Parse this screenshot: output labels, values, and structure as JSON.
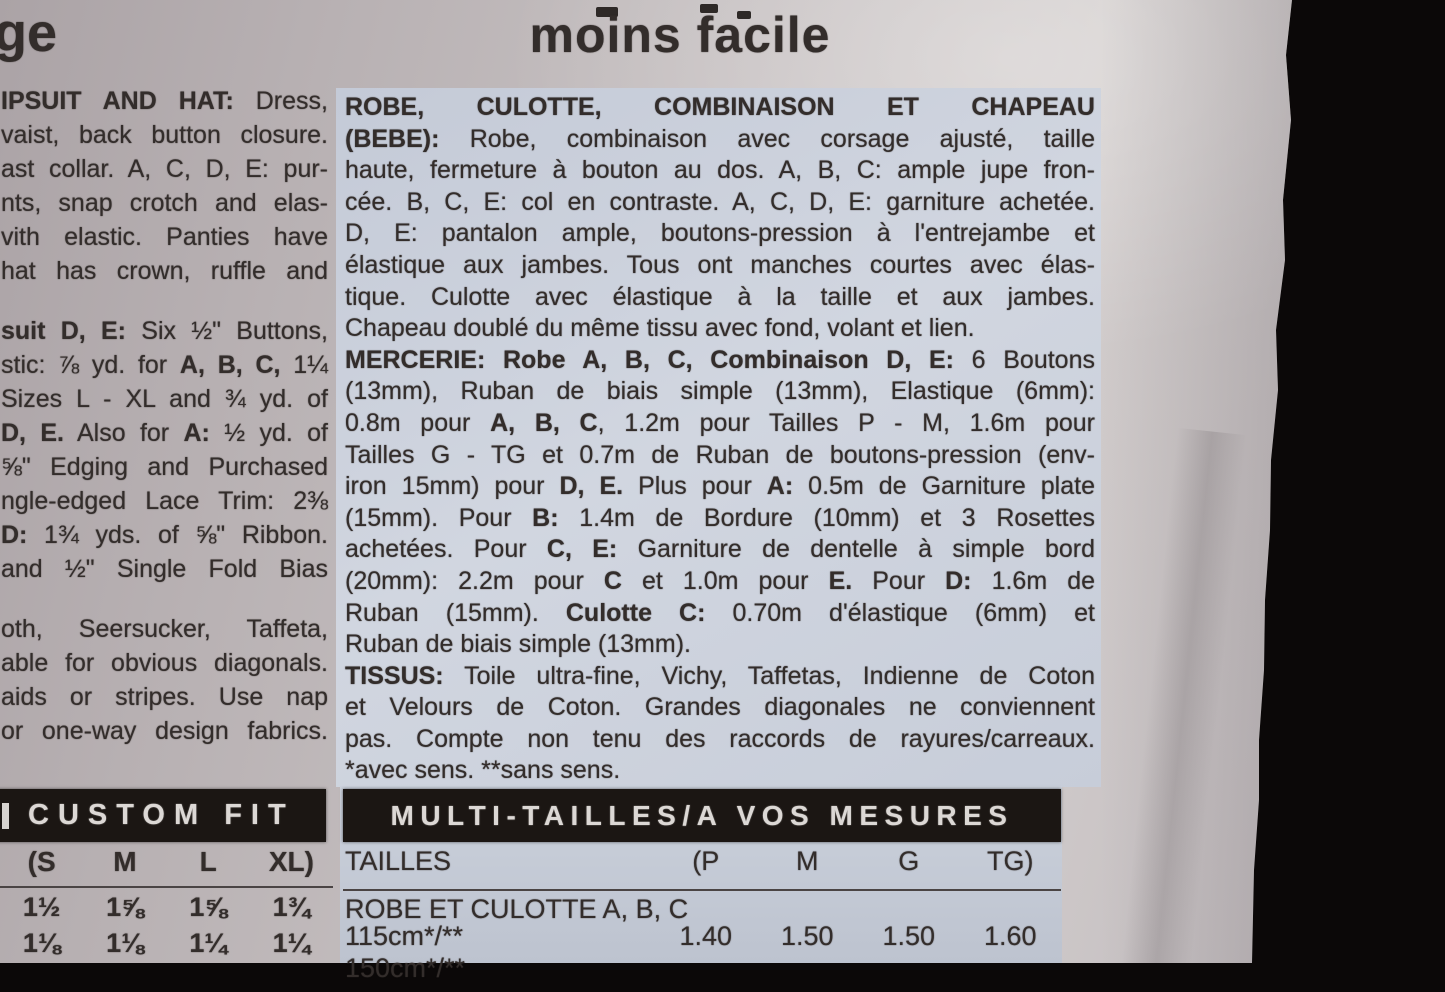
{
  "header": {
    "left_partial": "ge",
    "title": "moins facile"
  },
  "left_column": {
    "paragraphs": [
      {
        "lines": [
          {
            "s": [
              [
                "IPSUIT AND HAT:",
                1
              ],
              [
                " Dress,",
                0
              ]
            ]
          },
          {
            "s": [
              [
                "vaist, back button closure.",
                0
              ]
            ]
          },
          {
            "s": [
              [
                "ast collar. A, C, D, E: pur-",
                0
              ]
            ]
          },
          {
            "s": [
              [
                "nts, snap crotch and elas-",
                0
              ]
            ]
          },
          {
            "s": [
              [
                "vith elastic. Panties have",
                0
              ]
            ]
          },
          {
            "s": [
              [
                "hat has crown, ruffle and",
                0
              ]
            ]
          }
        ]
      },
      {
        "lines": [
          {
            "s": [
              [
                "suit D, E:",
                1
              ],
              [
                " Six ½\" Buttons,",
                0
              ]
            ]
          },
          {
            "s": [
              [
                "stic: ⅞ yd. for ",
                0
              ],
              [
                "A, B, C,",
                1
              ],
              [
                " 1¼",
                0
              ]
            ]
          },
          {
            "s": [
              [
                "Sizes L - XL and ¾ yd. of",
                0
              ]
            ]
          },
          {
            "s": [
              [
                "D, E.",
                1
              ],
              [
                " Also for ",
                0
              ],
              [
                "A:",
                1
              ],
              [
                " ½ yd. of",
                0
              ]
            ]
          },
          {
            "s": [
              [
                "⅝\" Edging and Purchased",
                0
              ]
            ]
          },
          {
            "s": [
              [
                "ngle-edged Lace Trim: 2⅜",
                0
              ]
            ]
          },
          {
            "s": [
              [
                "D:",
                1
              ],
              [
                " 1¾ yds. of ⅝\" Ribbon.",
                0
              ]
            ]
          },
          {
            "s": [
              [
                "and ½\" Single Fold Bias",
                0
              ]
            ]
          }
        ]
      },
      {
        "lines": [
          {
            "s": [
              [
                "oth, Seersucker, Taffeta,",
                0
              ]
            ]
          },
          {
            "s": [
              [
                "able for obvious diagonals.",
                0
              ]
            ]
          },
          {
            "s": [
              [
                "aids or stripes. Use nap",
                0
              ]
            ]
          },
          {
            "s": [
              [
                "or one-way design fabrics.",
                0
              ]
            ]
          }
        ]
      }
    ]
  },
  "french_column": {
    "paragraphs": [
      {
        "lines": [
          {
            "s": [
              [
                "ROBE, CULOTTE, COMBINAISON ET CHAPEAU",
                1
              ]
            ]
          },
          {
            "s": [
              [
                "(BEBE):",
                1
              ],
              [
                " Robe, combinaison avec corsage ajusté, taille",
                0
              ]
            ]
          },
          {
            "s": [
              [
                "haute, fermeture à bouton au dos. A, B, C: ample jupe fron-",
                0
              ]
            ]
          },
          {
            "s": [
              [
                "cée. B, C, E: col en contraste. A, C, D, E: garniture achetée.",
                0
              ]
            ]
          },
          {
            "s": [
              [
                "D, E: pantalon ample, boutons-pression à l'entrejambe et",
                0
              ]
            ]
          },
          {
            "s": [
              [
                "élastique aux jambes. Tous ont manches courtes avec élas-",
                0
              ]
            ]
          },
          {
            "s": [
              [
                "tique. Culotte avec élastique à la taille et aux jambes.",
                0
              ]
            ]
          },
          {
            "s": [
              [
                "Chapeau doublé du même tissu avec fond, volant et lien.",
                0
              ]
            ],
            "j": 0
          }
        ]
      },
      {
        "lines": [
          {
            "s": [
              [
                "MERCERIE: Robe A, B, C, Combinaison D, E:",
                1
              ],
              [
                " 6 Boutons",
                0
              ]
            ]
          },
          {
            "s": [
              [
                "(13mm), Ruban de biais simple (13mm), Elastique (6mm):",
                0
              ]
            ]
          },
          {
            "s": [
              [
                "0.8m pour ",
                0
              ],
              [
                "A, B, C",
                1
              ],
              [
                ", 1.2m pour Tailles P - M, 1.6m pour",
                0
              ]
            ]
          },
          {
            "s": [
              [
                "Tailles G - TG et 0.7m de Ruban de boutons-pression (env-",
                0
              ]
            ]
          },
          {
            "s": [
              [
                "iron 15mm) pour ",
                0
              ],
              [
                "D, E.",
                1
              ],
              [
                " Plus pour ",
                0
              ],
              [
                "A:",
                1
              ],
              [
                " 0.5m de Garniture plate",
                0
              ]
            ]
          },
          {
            "s": [
              [
                "(15mm). Pour ",
                0
              ],
              [
                "B:",
                1
              ],
              [
                " 1.4m de Bordure (10mm) et 3 Rosettes",
                0
              ]
            ]
          },
          {
            "s": [
              [
                "achetées. Pour ",
                0
              ],
              [
                "C, E:",
                1
              ],
              [
                " Garniture de dentelle à simple bord",
                0
              ]
            ]
          },
          {
            "s": [
              [
                "(20mm): 2.2m pour ",
                0
              ],
              [
                "C",
                1
              ],
              [
                " et 1.0m pour ",
                0
              ],
              [
                "E.",
                1
              ],
              [
                " Pour ",
                0
              ],
              [
                "D:",
                1
              ],
              [
                " 1.6m de",
                0
              ]
            ]
          },
          {
            "s": [
              [
                "Ruban (15mm). ",
                0
              ],
              [
                "Culotte C:",
                1
              ],
              [
                " 0.70m d'élastique (6mm) et",
                0
              ]
            ]
          },
          {
            "s": [
              [
                "Ruban de biais simple (13mm).",
                0
              ]
            ],
            "j": 0
          }
        ]
      },
      {
        "lines": [
          {
            "s": [
              [
                "TISSUS:",
                1
              ],
              [
                " Toile ultra-fine, Vichy, Taffetas, Indienne de Coton",
                0
              ]
            ]
          },
          {
            "s": [
              [
                "et Velours de Coton. Grandes diagonales ne conviennent",
                0
              ]
            ]
          },
          {
            "s": [
              [
                "pas. Compte non tenu des raccords de rayures/carreaux.",
                0
              ]
            ]
          },
          {
            "s": [
              [
                "*avec sens. **sans sens.",
                0
              ]
            ],
            "j": 0
          }
        ]
      }
    ]
  },
  "custom_fit_table": {
    "title": "CUSTOM FIT",
    "size_headers": [
      "(S",
      "M",
      "L",
      "XL)"
    ],
    "rows": [
      [
        "1½",
        "1⅝",
        "1⅝",
        "1¾"
      ],
      [
        "1⅛",
        "1⅛",
        "1¼",
        "1¼"
      ]
    ]
  },
  "multi_size_table": {
    "title": "MULTI-TAILLES/A VOS MESURES",
    "row_label_header": "TAILLES",
    "size_headers": [
      "(P",
      "M",
      "G",
      "TG)"
    ],
    "section": "ROBE ET CULOTTE A, B, C",
    "rows": [
      {
        "label": "115cm*/**",
        "values": [
          "1.40",
          "1.50",
          "1.50",
          "1.60"
        ]
      },
      {
        "label": "150cm*/**",
        "values": []
      }
    ]
  },
  "colors": {
    "background": "#0b0808",
    "paper": "#c6c0c1",
    "highlight_tint": "#cbd1dc",
    "header_bar": "#1b1613",
    "header_bar_text": "#dcd8d5",
    "ink": "#332d2b"
  }
}
